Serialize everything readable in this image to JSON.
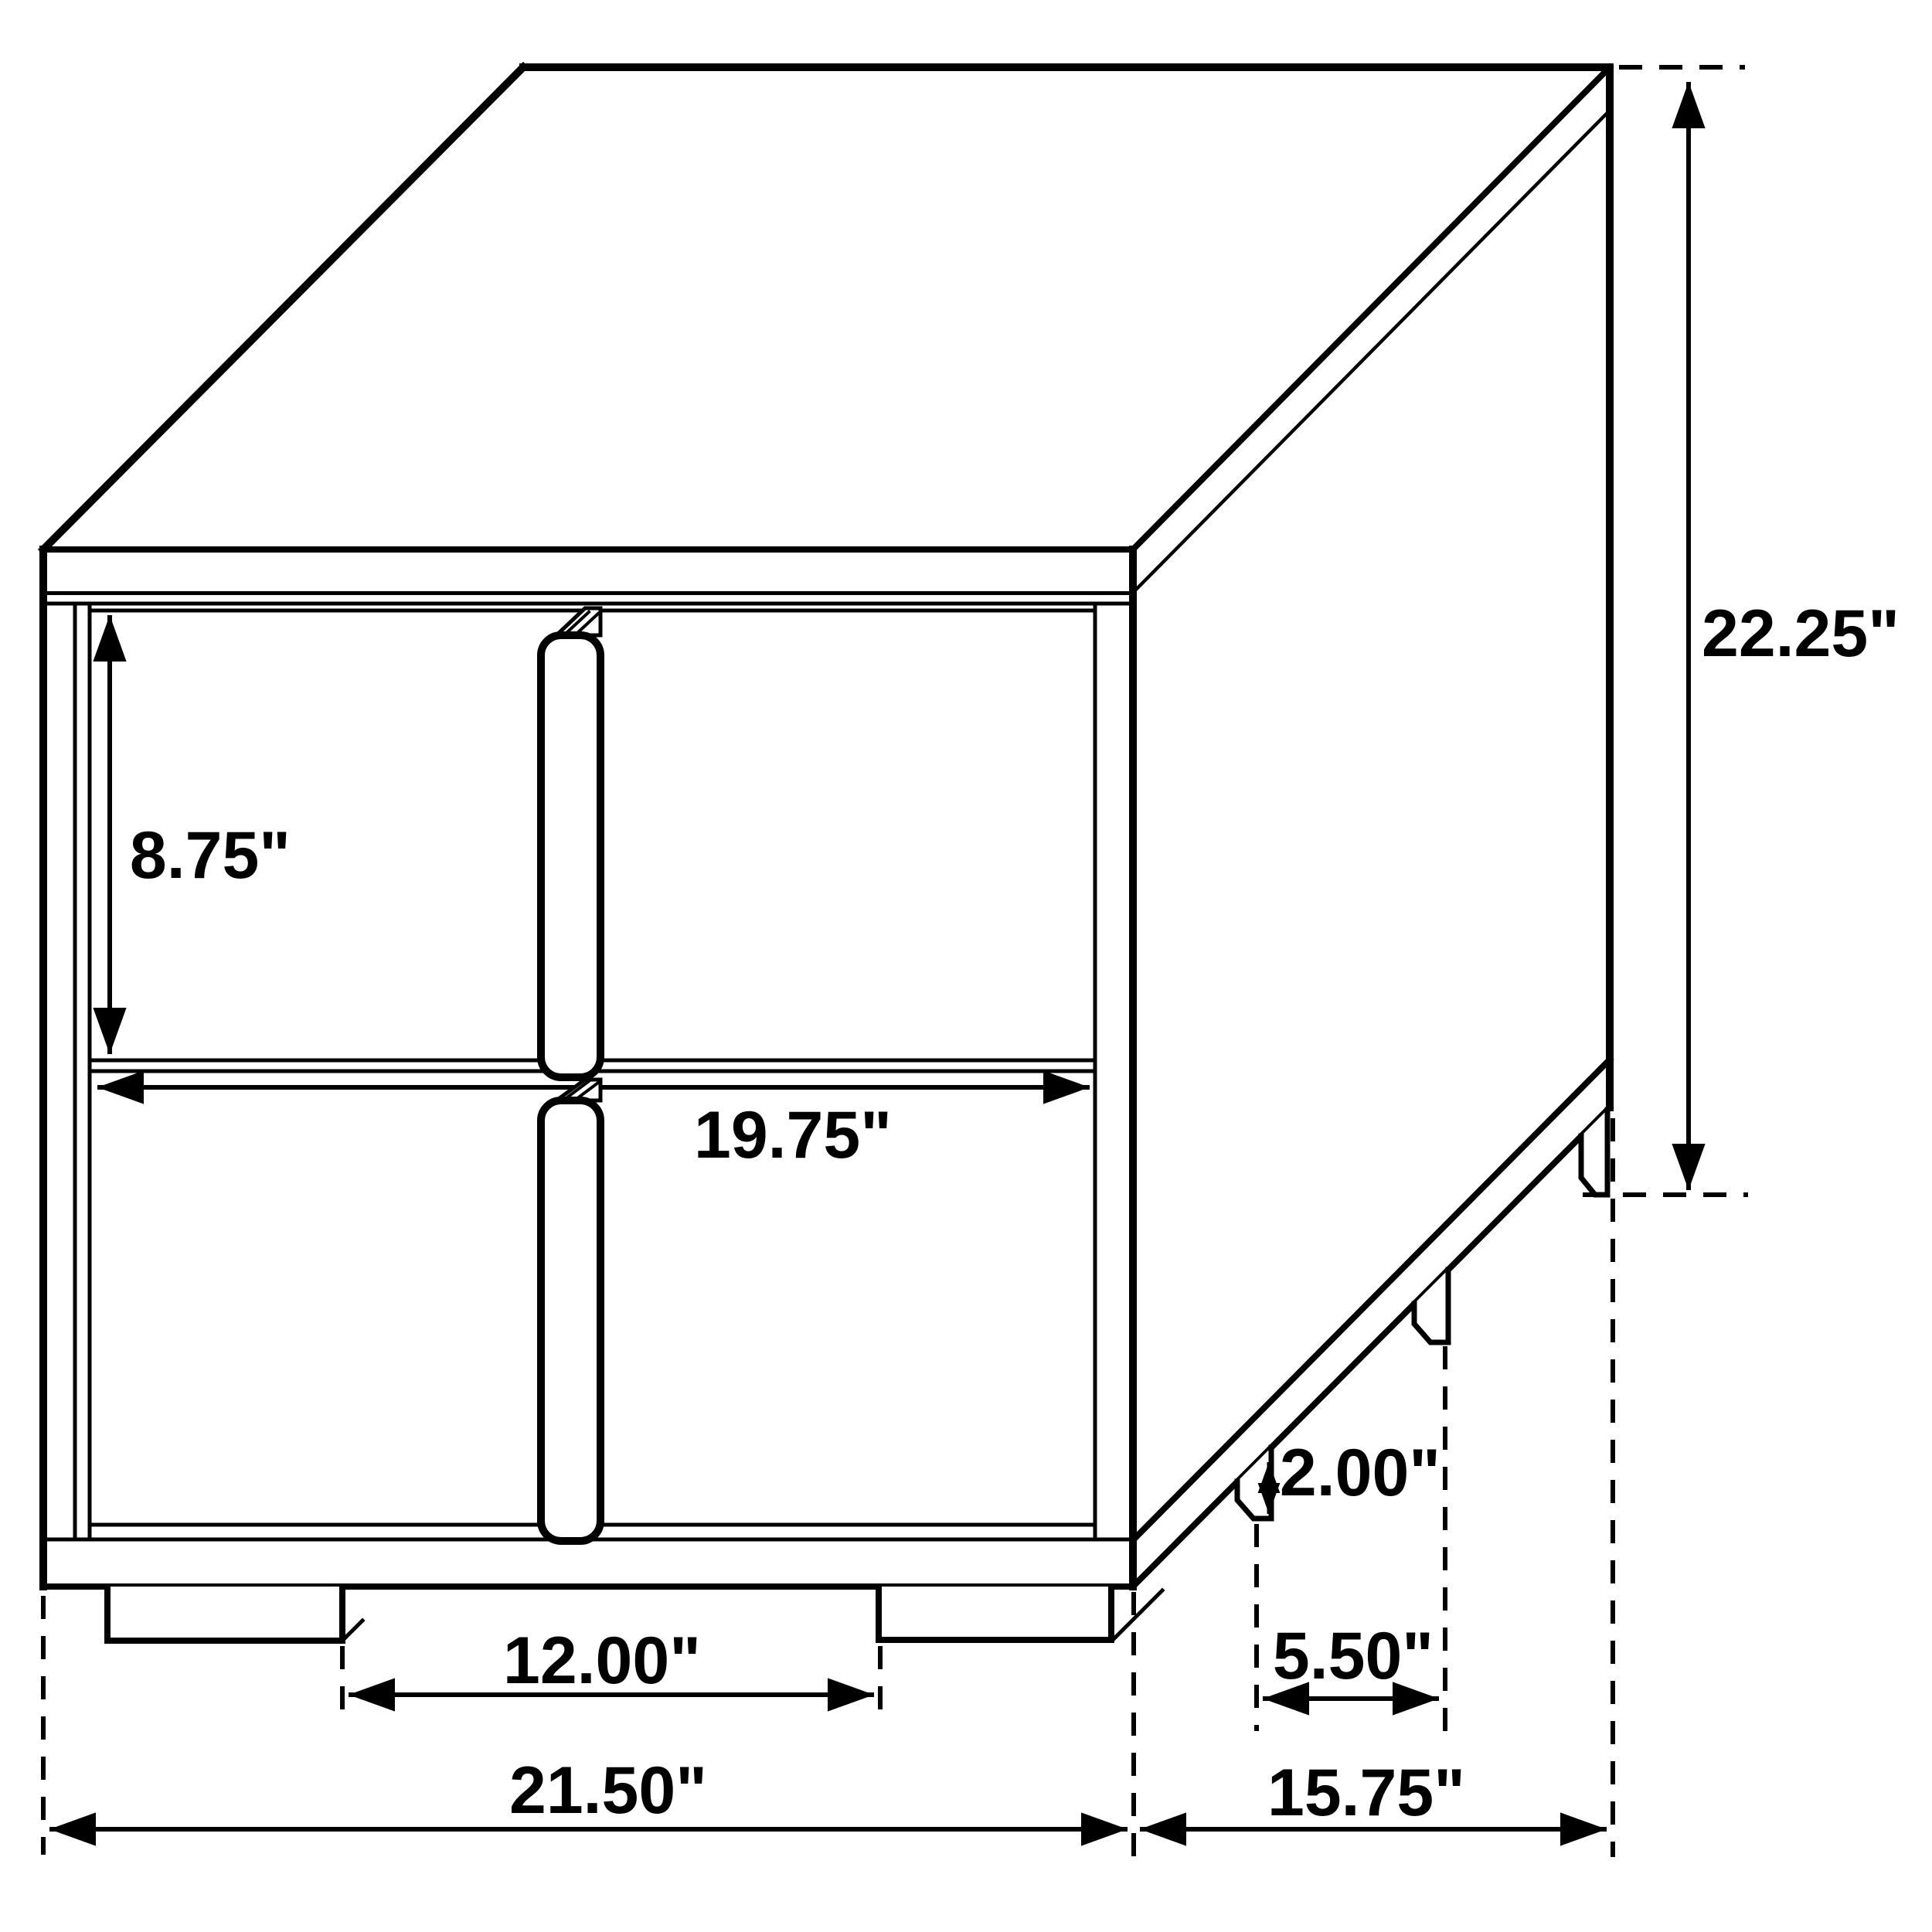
{
  "diagram": {
    "type": "furniture-dimension-drawing",
    "subject": "two-drawer nightstand isometric view",
    "background": "#ffffff",
    "line_color": "#000000",
    "units": "inches",
    "dimensions": {
      "drawer_front_height": {
        "label": "8.75\"",
        "value": 8.75
      },
      "drawer_front_width": {
        "label": "19.75\"",
        "value": 19.75
      },
      "overall_height": {
        "label": "22.25\"",
        "value": 22.25
      },
      "foot_height": {
        "label": "2.00\"",
        "value": 2.0
      },
      "front_foot_spacing": {
        "label": "12.00\"",
        "value": 12.0
      },
      "side_foot_spacing": {
        "label": "5.50\"",
        "value": 5.5
      },
      "overall_width": {
        "label": "21.50\"",
        "value": 21.5
      },
      "overall_depth": {
        "label": "15.75\"",
        "value": 15.75
      }
    }
  }
}
